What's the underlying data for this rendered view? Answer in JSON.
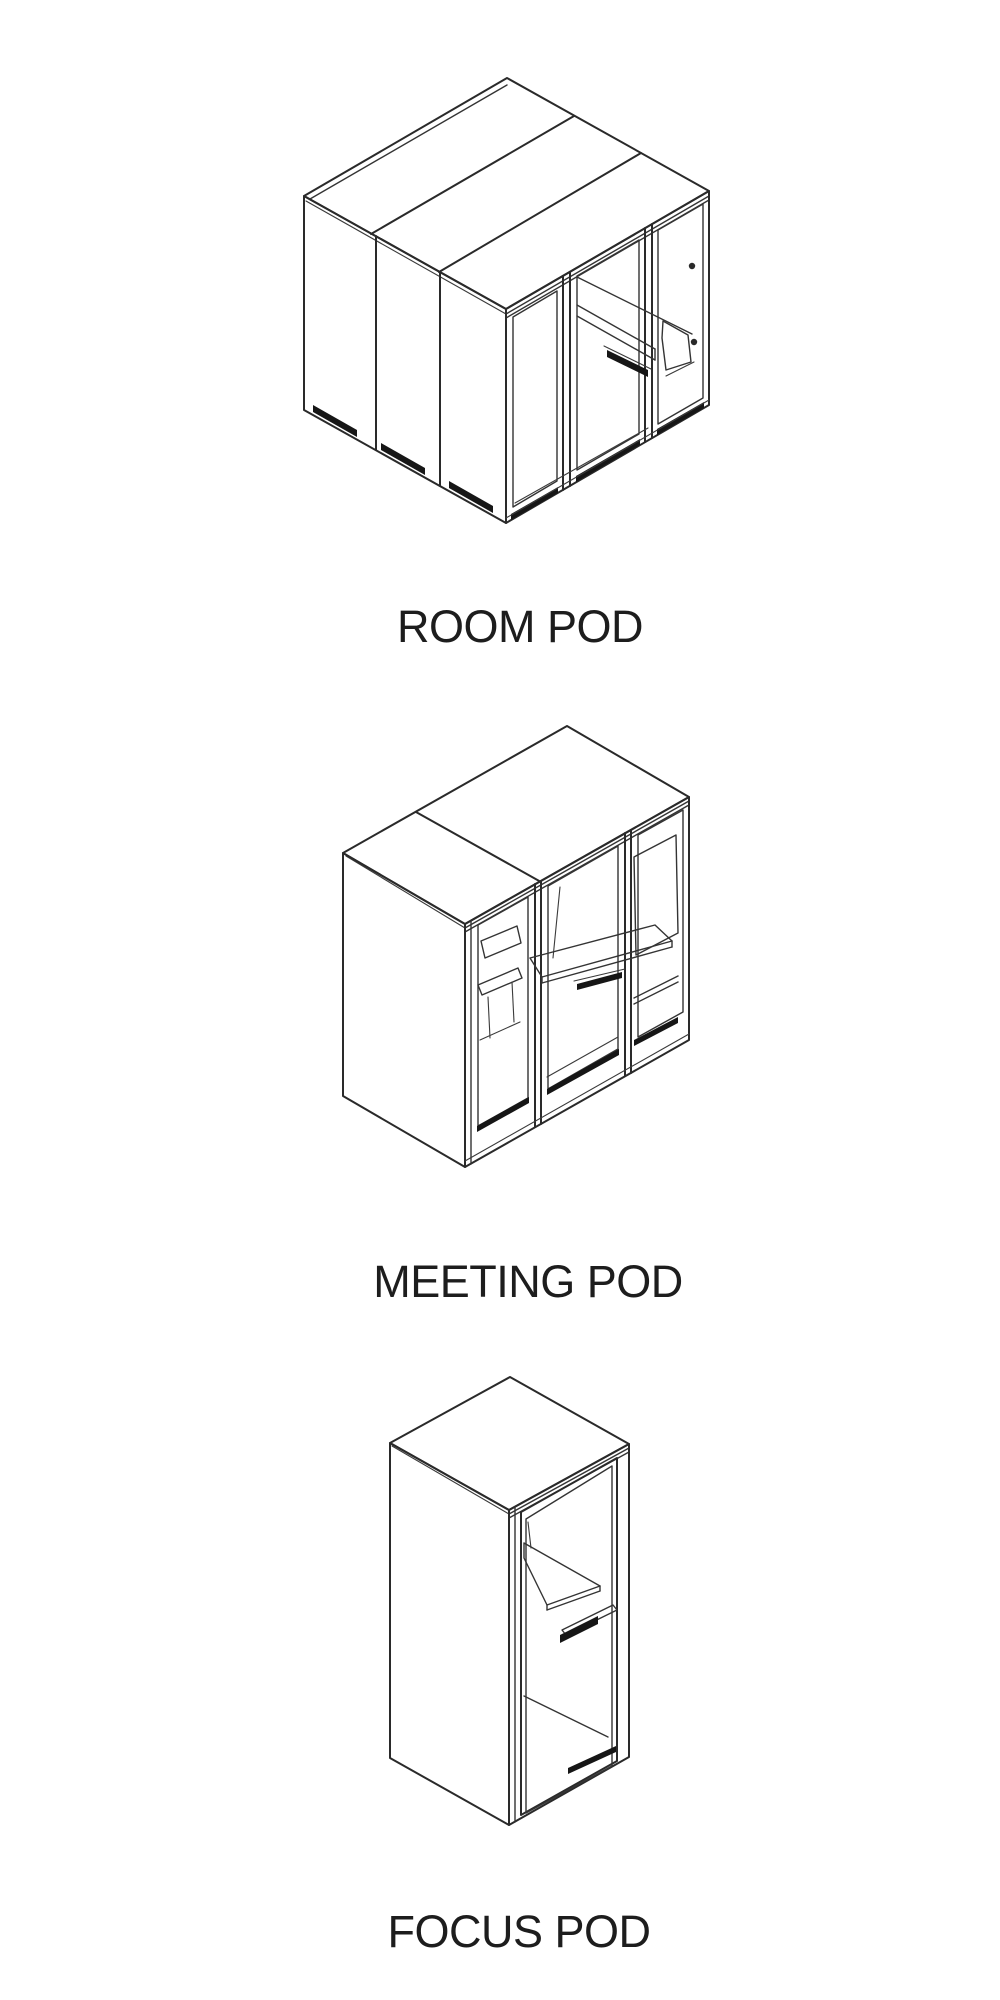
{
  "page": {
    "background": "#ffffff",
    "line_color": "#2a2a2a",
    "label_color": "#1d1d1d"
  },
  "pods": [
    {
      "id": "room-pod",
      "label": "ROOM POD"
    },
    {
      "id": "meeting-pod",
      "label": "MEETING POD"
    },
    {
      "id": "focus-pod",
      "label": "FOCUS POD"
    }
  ]
}
